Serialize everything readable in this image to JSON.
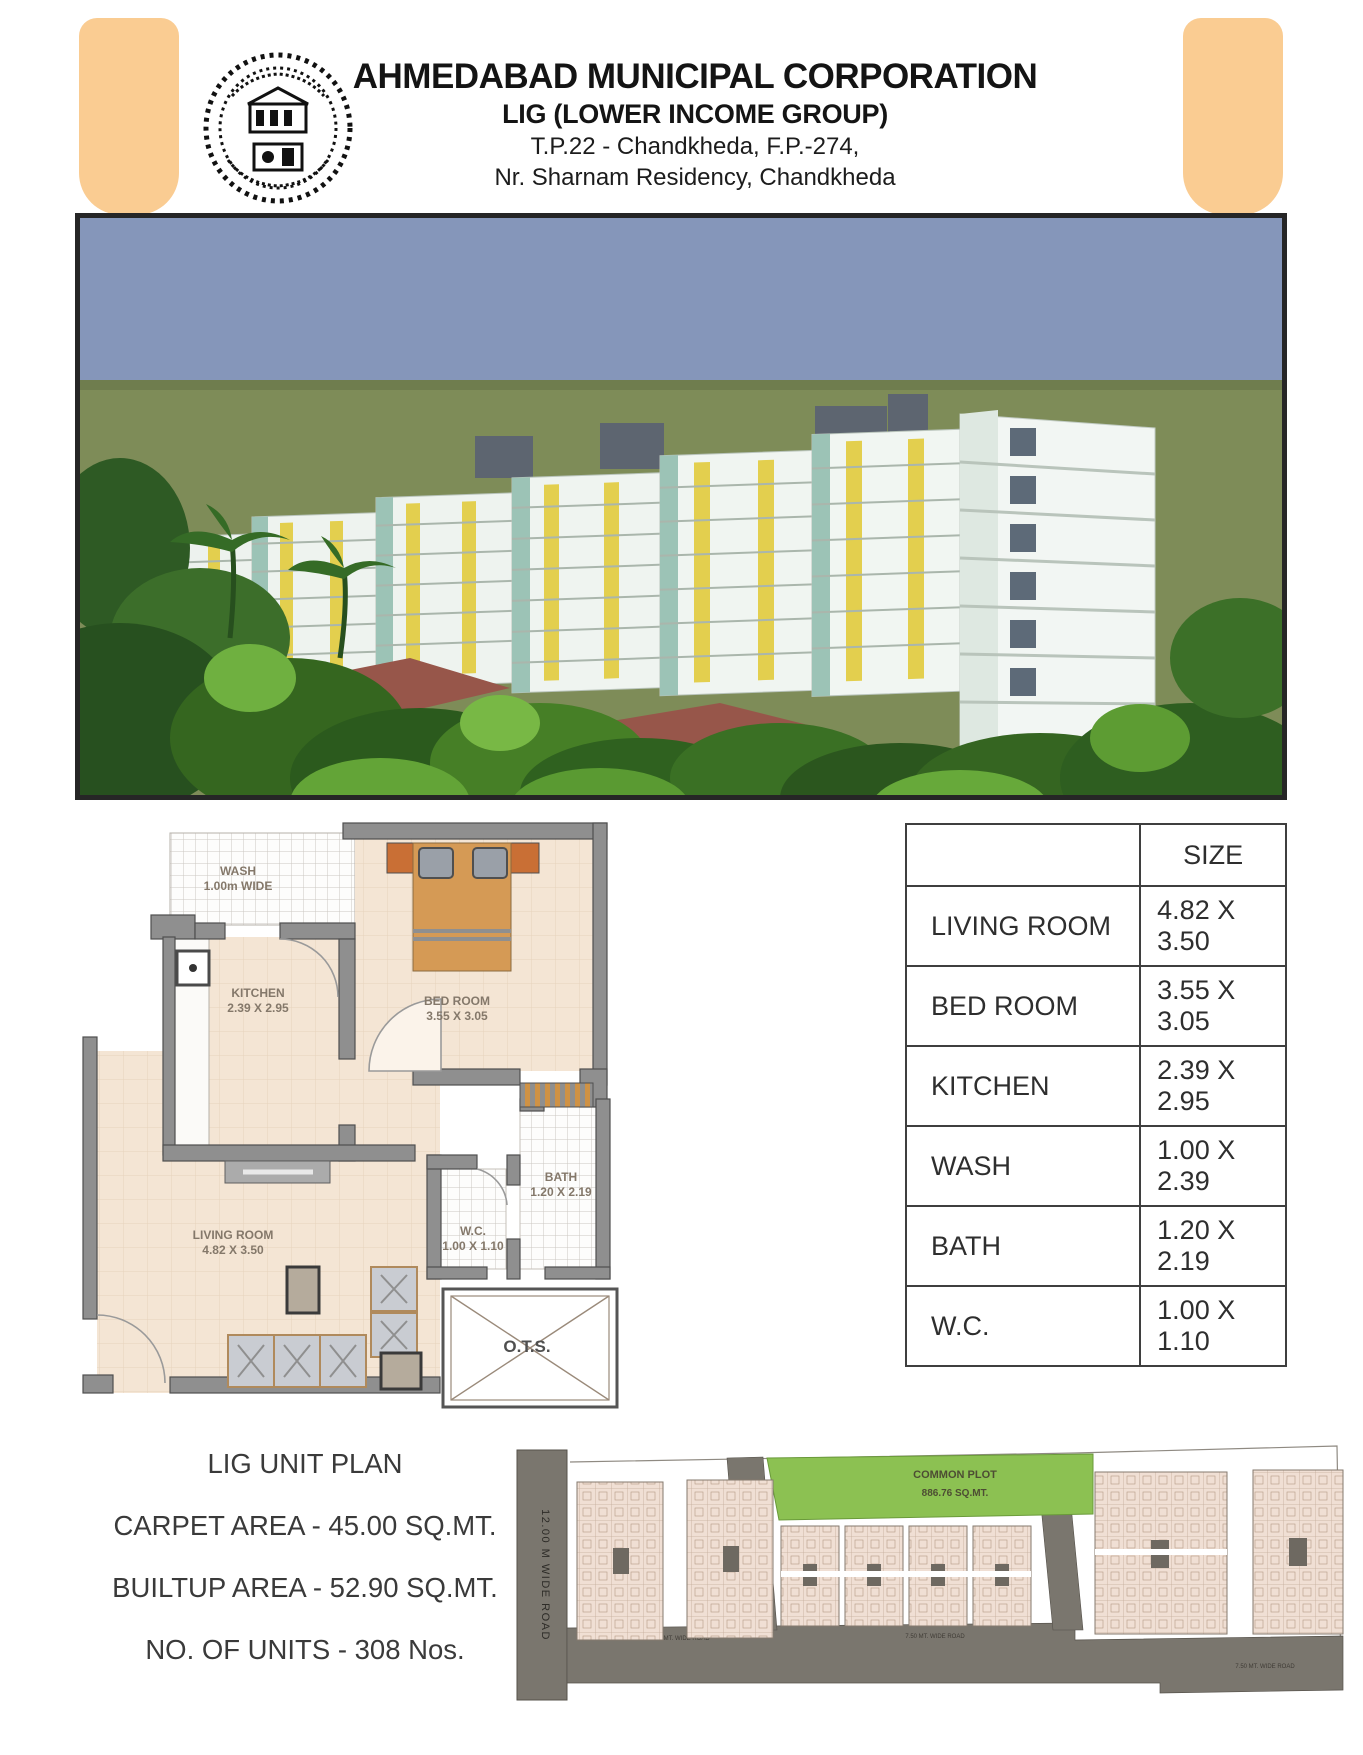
{
  "header": {
    "title": "AHMEDABAD MUNICIPAL CORPORATION",
    "subtitle": "LIG (LOWER INCOME GROUP)",
    "address_line1": "T.P.22 - Chandkheda, F.P.-274,",
    "address_line2": "Nr. Sharnam Residency, Chandkheda"
  },
  "size_table": {
    "size_header": "SIZE",
    "rows": [
      {
        "room": "LIVING ROOM",
        "size": "4.82 X 3.50"
      },
      {
        "room": "BED ROOM",
        "size": "3.55 X 3.05"
      },
      {
        "room": "KITCHEN",
        "size": "2.39 X 2.95"
      },
      {
        "room": "WASH",
        "size": "1.00 X 2.39"
      },
      {
        "room": "BATH",
        "size": "1.20 X 2.19"
      },
      {
        "room": "W.C.",
        "size": "1.00 X 1.10"
      }
    ]
  },
  "floor_plan": {
    "wash_label": "WASH",
    "wash_size": "1.00m WIDE",
    "kitchen_label": "KITCHEN",
    "kitchen_size": "2.39 X 2.95",
    "bedroom_label": "BED ROOM",
    "bedroom_size": "3.55 X 3.05",
    "living_label": "LIVING ROOM",
    "living_size": "4.82 X 3.50",
    "bath_label": "BATH",
    "bath_size": "1.20 X 2.19",
    "wc_label": "W.C.",
    "wc_size": "1.00 X 1.10",
    "ots_label": "O.T.S."
  },
  "site_plan": {
    "left_road_label": "12.00 M WIDE ROAD",
    "common_plot_line1": "COMMON PLOT",
    "common_plot_line2": "886.76 SQ.MT.",
    "road_label_1": "7.50 MT. WIDE ROAD",
    "road_label_2": "7.50 MT. WIDE ROAD",
    "road_label_3": "7.50 MT. WIDE ROAD"
  },
  "summary": {
    "plan_title": "LIG UNIT PLAN",
    "carpet_area": "CARPET AREA - 45.00 SQ.MT.",
    "builtup_area": "BUILTUP AREA - 52.90 SQ.MT.",
    "units": "NO. OF UNITS - 308 Nos."
  },
  "colors": {
    "accent_bar": "#FACC92",
    "common_plot_green": "#8CC152",
    "render_sky": "#8596BA",
    "render_grass": "#7E8C58"
  }
}
